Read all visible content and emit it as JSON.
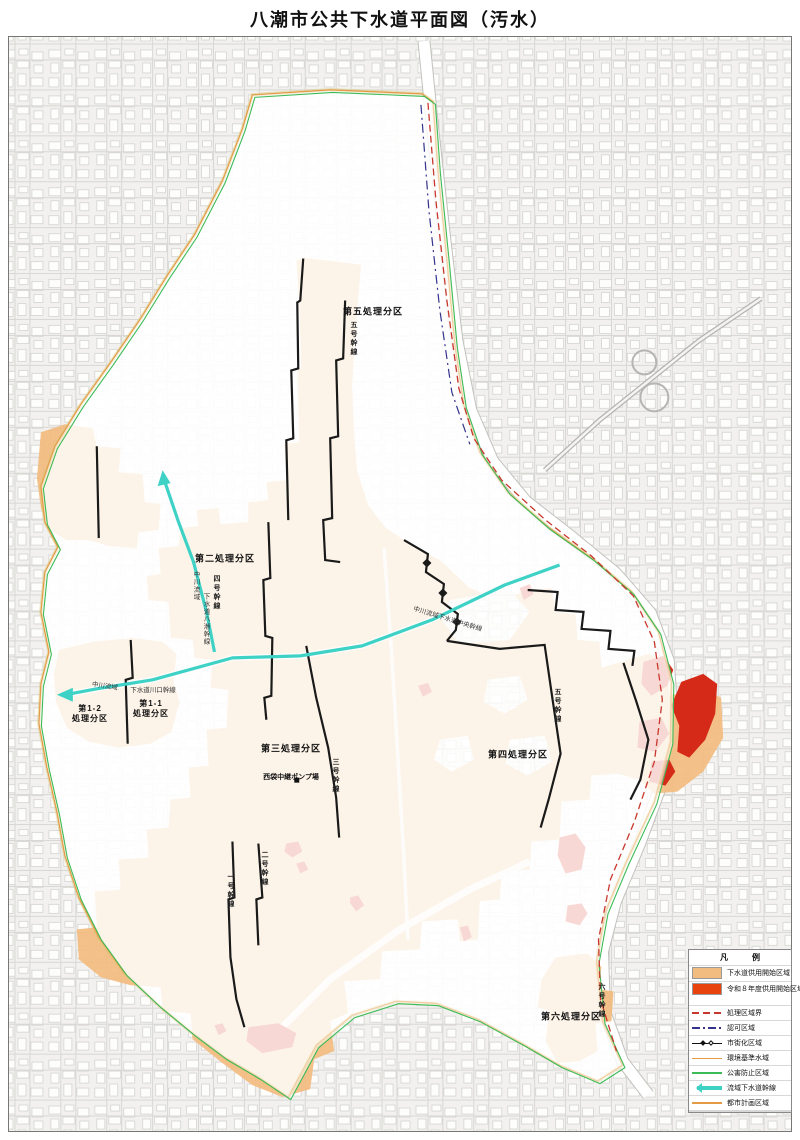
{
  "title": "八潮市公共下水道平面図（汚水）",
  "colors": {
    "served-area": "#F2BC80",
    "new-area": "#D62A18",
    "legend-new": "#E8430D",
    "trunk-cyan": "#3ED2C6",
    "bnd-orange": "#E59A45",
    "bnd-green": "#3DBB57",
    "bnd-red": "#C8372D",
    "navy": "#33338C"
  },
  "legend": {
    "title": "凡　　　例",
    "items": [
      {
        "label": "下水道供用開始区域"
      },
      {
        "label": "令和８年度供用開始区域"
      },
      {
        "label": "処理区域界"
      },
      {
        "label": "認可区域"
      },
      {
        "label": "市街化区域"
      },
      {
        "label": "環境基準水域"
      },
      {
        "label": "公害防止区域"
      },
      {
        "label": "流域下水道幹線"
      },
      {
        "label": "都市計画区域"
      }
    ]
  },
  "map": {
    "districts": [
      {
        "text": "第五処理分区"
      },
      {
        "text": "第二処理分区"
      },
      {
        "text": "第三処理分区"
      },
      {
        "text": "第四処理分区"
      },
      {
        "text": "第六処理分区"
      },
      {
        "text": "第1-2\n処理分区"
      },
      {
        "text": "第1-1\n処理分区"
      },
      {
        "text": "西袋中継ポンプ場"
      }
    ],
    "trunk_labels": [
      {
        "text": "五号幹線"
      },
      {
        "text": "四号幹線"
      },
      {
        "text": "三号幹線"
      },
      {
        "text": "二号幹線"
      },
      {
        "text": "一号幹線"
      },
      {
        "text": "五号幹線"
      },
      {
        "text": "六号幹線"
      }
    ],
    "flow_labels": [
      {
        "text": "中川流域下水道中央幹線"
      },
      {
        "text": "中川流域"
      },
      {
        "text": "下水道川口幹線"
      },
      {
        "text": "中川流域"
      },
      {
        "text": "下水道八潮幹線"
      }
    ]
  }
}
